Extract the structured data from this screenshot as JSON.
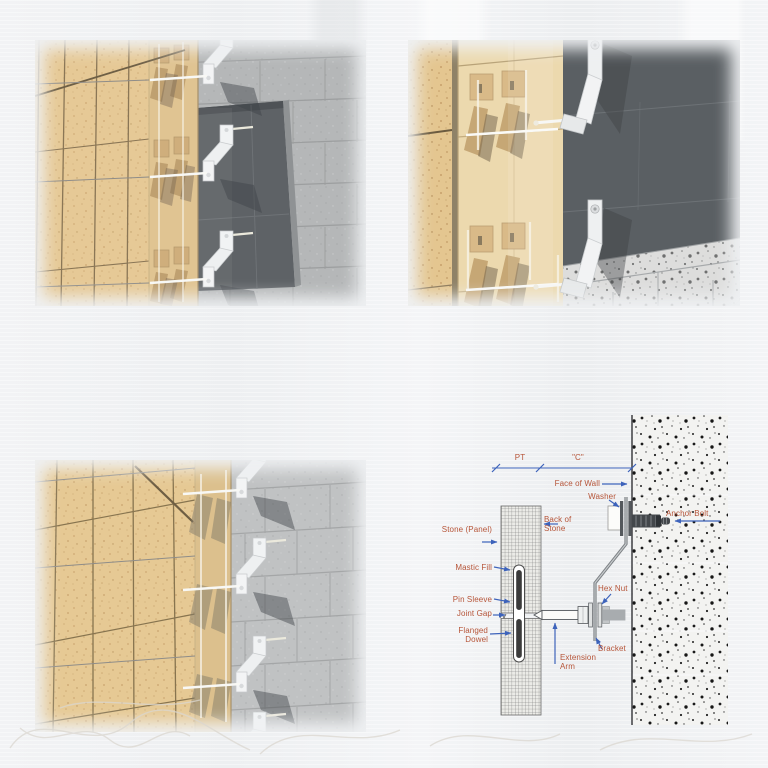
{
  "page": {
    "background_color": "#eff1f3"
  },
  "renderings": {
    "top_left": {
      "description": "Tan stone cladding panels anchored with white Z-brackets to a concrete block wall beside a dark recessed panel"
    },
    "top_right": {
      "description": "Close-up of translucent stone panel over tan anchor plates, white Z-brackets bolted to a dark wall above speckled concrete block"
    },
    "bottom_left": {
      "description": "Tan stone cladding with a vertical row of white anchor brackets fastened to a gray concrete block wall"
    }
  },
  "diagram": {
    "dimensions": {
      "pt": "PT",
      "c": "\"C\""
    },
    "labels": {
      "face_of_wall": "Face of Wall",
      "washer": "Washer",
      "anchor_bolt": "Anchor Bolt",
      "back_of_stone": "Back of Stone",
      "stone_panel": "Stone (Panel)",
      "mastic_fill": "Mastic Fill",
      "pin_sleeve": "Pin Sleeve",
      "joint_gap": "Joint Gap",
      "flanged_dowel": "Flanged Dowel",
      "hex_nut": "Hex Nut",
      "bracket": "Bracket",
      "extension_arm": "Extension Arm"
    },
    "colors": {
      "label_text": "#b65539",
      "arrow": "#3d63bb",
      "wall_line": "#4a4a4e",
      "concrete_speckle": "#1b1b1b"
    }
  },
  "palette": {
    "stone_tan": "#e6c996",
    "block_wall_gray": "#b5b7b8",
    "dark_recess": "#5e6266",
    "dark_wall": "#5a5f63",
    "bracket_white": "#f2f3f4"
  }
}
